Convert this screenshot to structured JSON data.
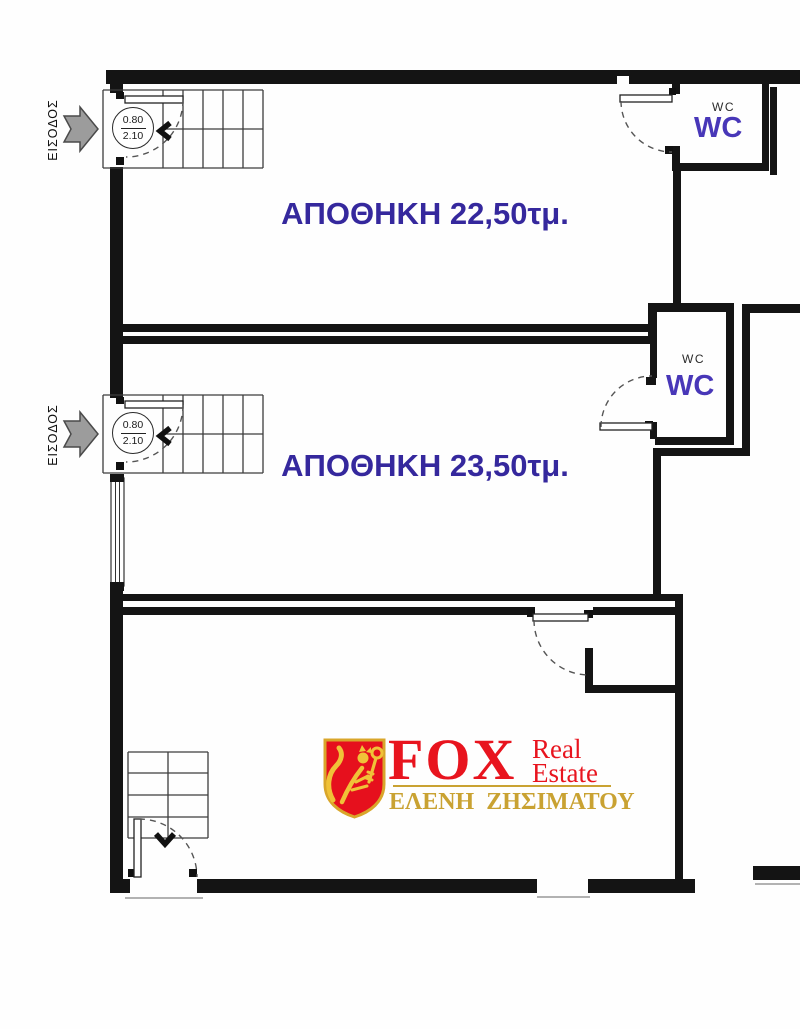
{
  "plan": {
    "entrance1": {
      "label": "ΕΙΣΟΔΟΣ",
      "door_width": "0.80",
      "door_height": "2.10"
    },
    "entrance2": {
      "label": "ΕΙΣΟΔΟΣ",
      "door_width": "0.80",
      "door_height": "2.10"
    },
    "room1": {
      "label": "ΑΠΟΘΗΚΗ 22,50τμ."
    },
    "room2": {
      "label": "ΑΠΟΘΗΚΗ 23,50τμ."
    },
    "wc1": {
      "small_label": "WC",
      "large_label": "WC"
    },
    "wc2": {
      "small_label": "WC",
      "large_label": "WC"
    },
    "logo": {
      "brand": "FOX",
      "word1": "Real",
      "word2": "Estate",
      "agent": "ΕΛΕΝΗ ΖΗΣΙΜΑΤΟΥ"
    },
    "colors": {
      "room_label": "#35289d",
      "wc_label": "#4837b8",
      "logo_red": "#e8141e",
      "logo_gold": "#c9a232",
      "arrow_gray": "#9c9c9c",
      "wall_black": "#141414"
    }
  }
}
